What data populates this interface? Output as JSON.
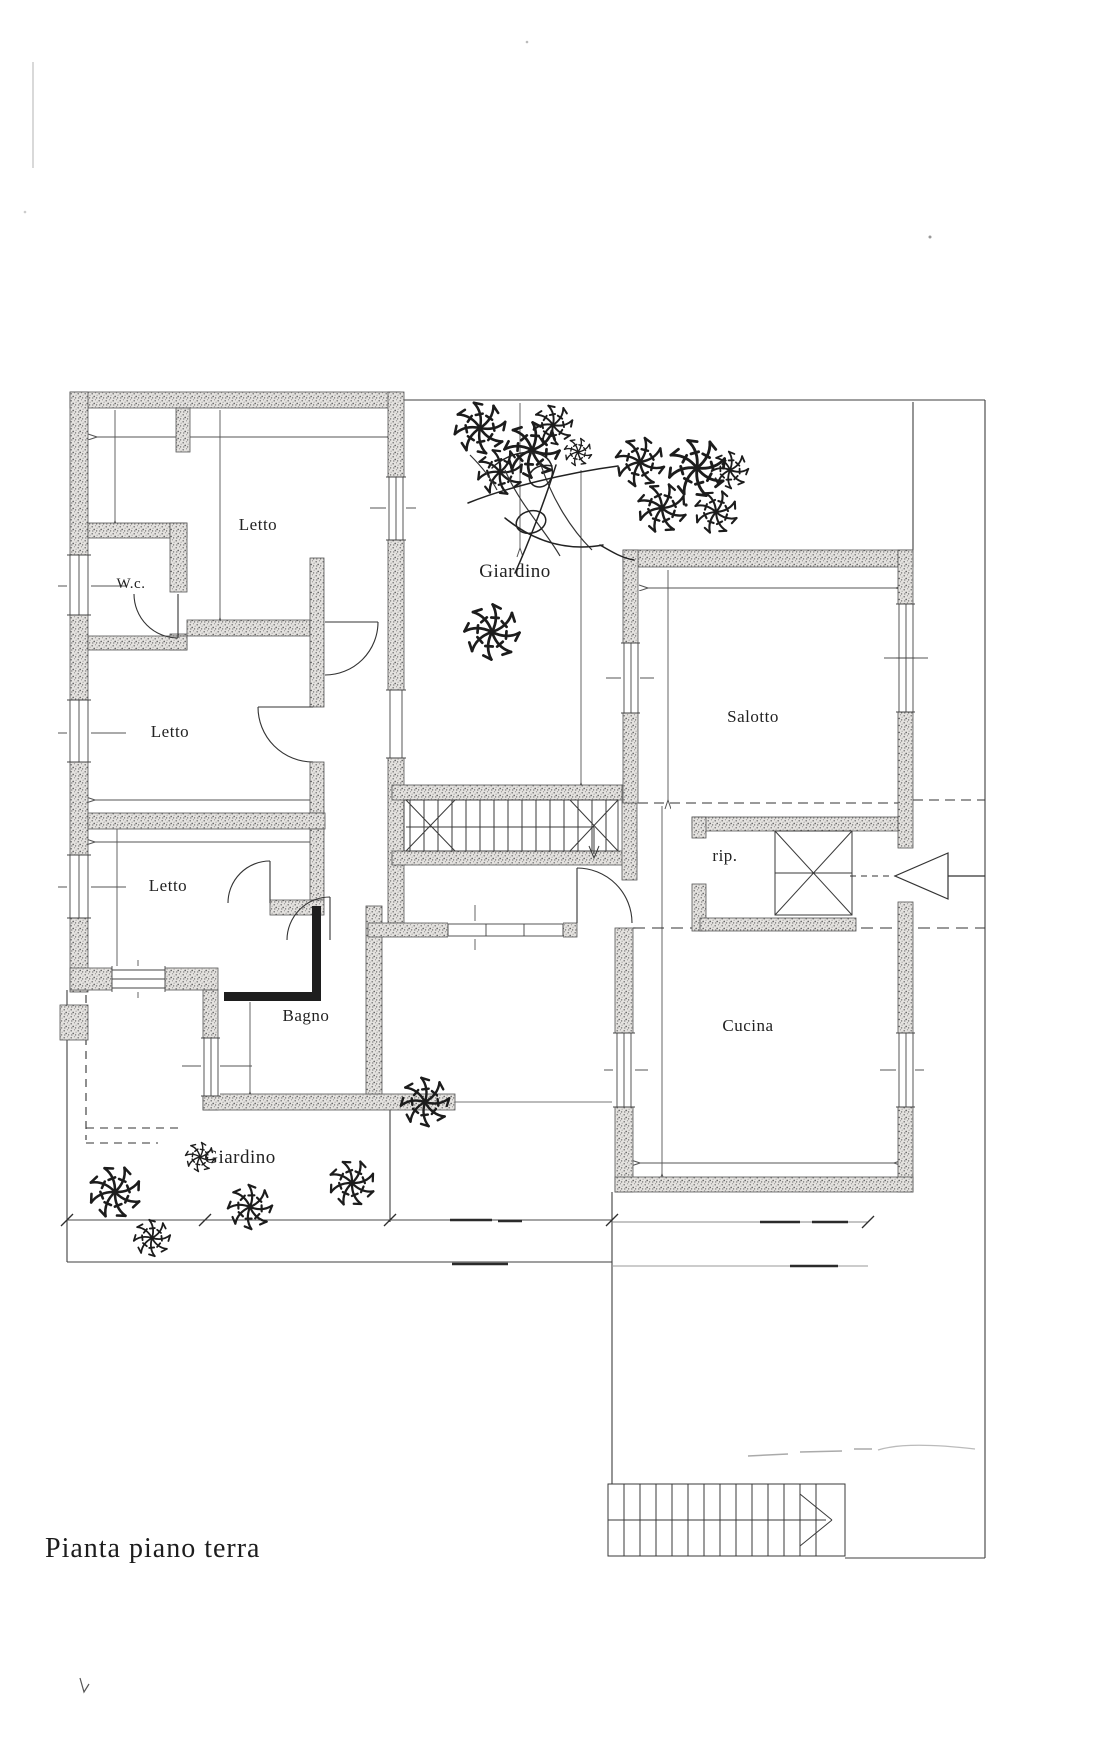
{
  "document": {
    "title": "Pianta piano terra"
  },
  "plan": {
    "rooms": [
      {
        "id": "letto-1",
        "label": "Letto"
      },
      {
        "id": "wc",
        "label": "W.c."
      },
      {
        "id": "giardino-top",
        "label": "Giardino"
      },
      {
        "id": "salotto",
        "label": "Salotto"
      },
      {
        "id": "letto-2",
        "label": "Letto"
      },
      {
        "id": "rip",
        "label": "rip."
      },
      {
        "id": "letto-3",
        "label": "Letto"
      },
      {
        "id": "bagno",
        "label": "Bagno"
      },
      {
        "id": "cucina",
        "label": "Cucina"
      },
      {
        "id": "giardino-bottom",
        "label": "Giardino"
      }
    ],
    "colors": {
      "ink": "#2a2a2a",
      "wall_fill": "#e4e2df",
      "wall_speckle": "#6e6e6e",
      "boundary_line": "#3f3f3f",
      "dimension_line": "#555555",
      "faint_artifact": "#b5b5b5"
    }
  }
}
